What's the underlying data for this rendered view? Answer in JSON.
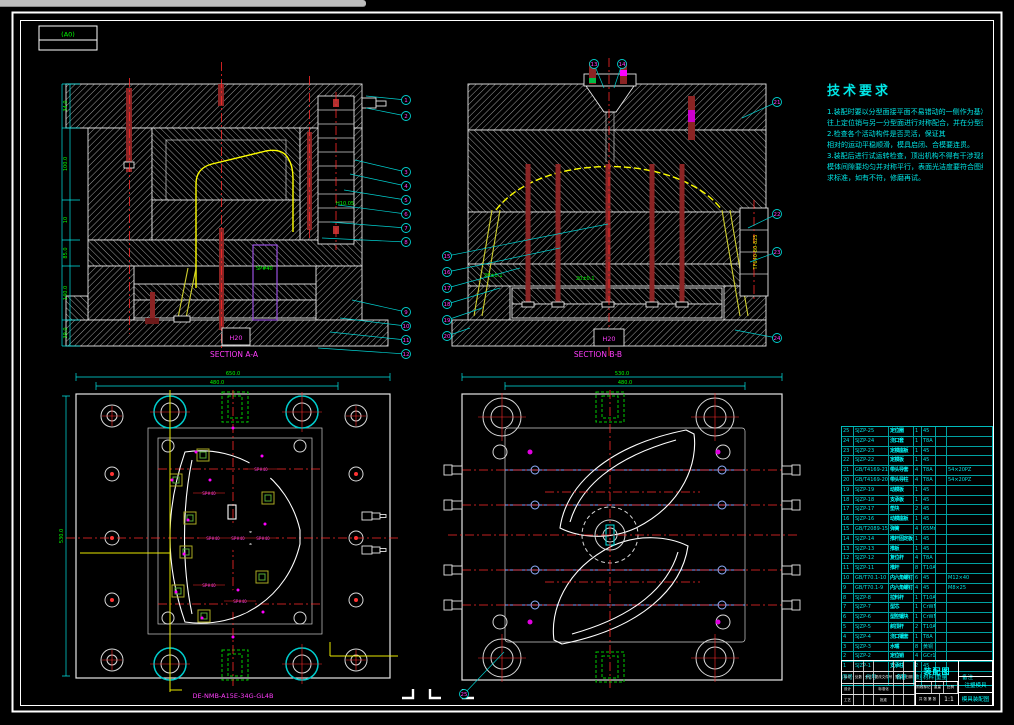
{
  "frame": {
    "format_label": "(A0)"
  },
  "sections": {
    "a": "SECTION A-A",
    "b": "SECTION B-B"
  },
  "tech_requirements": {
    "title": "技术要求",
    "lines": [
      "1.装配时要以分型面接平面不易错动的一侧作为基准，",
      "往上定位销与另一分型面进行对称配合，并在分型面留有间隙。",
      "2.检查各个活动构件是否灵活，保证其",
      "相对的运动平稳顺滑，模具启闭、合模要连贯。",
      "3.装配后进行试运转检查，顶出机构不得有干涉现象，",
      "模体间隙要均匀并对称平行，表面光洁度要符合图纸要",
      "求标准，如有不符，修磨再试。"
    ]
  },
  "view_tl": {
    "dims_left": [
      "34.0",
      "100.0",
      "10",
      "85.0",
      "140.0",
      "39.0"
    ],
    "label_sp": "SP#40",
    "label_h": "H10.05",
    "label_h20": "H20"
  },
  "view_tr": {
    "label_tf": "TF640-80-825",
    "label_h20": "H20",
    "tol_left": "20±0.1",
    "tol_right": "20±0.1"
  },
  "view_bl": {
    "dim_top1": "650.0",
    "dim_top2": "480.0",
    "dim_left": "530.0",
    "sp_label": "SP#40",
    "part_no": "DE-NMB-A15E-34G-GL4B"
  },
  "view_br": {
    "dim_top1": "530.0",
    "dim_top2": "480.0"
  },
  "bom": {
    "headers": [
      "序号",
      "代号",
      "名称",
      "数量",
      "材料",
      "重量",
      "备注"
    ],
    "rows": [
      [
        "25",
        "SJZP-25",
        "定位圈",
        "1",
        "45",
        "",
        ""
      ],
      [
        "24",
        "SJZP-24",
        "浇口套",
        "1",
        "T8A",
        "",
        ""
      ],
      [
        "23",
        "SJZP-23",
        "定模座板",
        "1",
        "45",
        "",
        ""
      ],
      [
        "22",
        "SJZP-22",
        "定模板",
        "1",
        "45",
        "",
        ""
      ],
      [
        "21",
        "GB/T4169-21",
        "带头导套",
        "4",
        "T8A",
        "",
        "54×20PZ"
      ],
      [
        "20",
        "GB/T4169-20",
        "带头导柱",
        "4",
        "T8A",
        "",
        "54×20PZ"
      ],
      [
        "19",
        "SJZP-19",
        "动模板",
        "1",
        "45",
        "",
        ""
      ],
      [
        "18",
        "SJZP-18",
        "支承板",
        "1",
        "45",
        "",
        ""
      ],
      [
        "17",
        "SJZP-17",
        "垫块",
        "2",
        "45",
        "",
        ""
      ],
      [
        "16",
        "SJZP-16",
        "动模座板",
        "1",
        "45",
        "",
        ""
      ],
      [
        "15",
        "GB/T2089-15",
        "弹簧",
        "4",
        "65Mn",
        "",
        ""
      ],
      [
        "14",
        "SJZP-14",
        "推杆固定板",
        "1",
        "45",
        "",
        ""
      ],
      [
        "13",
        "SJZP-13",
        "推板",
        "1",
        "45",
        "",
        ""
      ],
      [
        "12",
        "SJZP-12",
        "复位杆",
        "4",
        "T8A",
        "",
        ""
      ],
      [
        "11",
        "SJZP-11",
        "推杆",
        "8",
        "T10A",
        "",
        ""
      ],
      [
        "10",
        "GB/T70.1-10",
        "内六角螺钉",
        "6",
        "45",
        "",
        "M12×40"
      ],
      [
        "9",
        "GB/T70.1-9",
        "内六角螺钉",
        "4",
        "45",
        "",
        "M8×25"
      ],
      [
        "8",
        "SJZP-8",
        "拉料杆",
        "1",
        "T10A",
        "",
        ""
      ],
      [
        "7",
        "SJZP-7",
        "型芯",
        "1",
        "CrWMn",
        "",
        ""
      ],
      [
        "6",
        "SJZP-6",
        "型腔镶块",
        "1",
        "CrWMn",
        "",
        ""
      ],
      [
        "5",
        "SJZP-5",
        "斜顶杆",
        "2",
        "T10A",
        "",
        ""
      ],
      [
        "4",
        "SJZP-4",
        "浇口镶套",
        "1",
        "T8A",
        "",
        ""
      ],
      [
        "3",
        "SJZP-3",
        "水嘴",
        "8",
        "黄铜",
        "",
        ""
      ],
      [
        "2",
        "SJZP-2",
        "定位销",
        "4",
        "GCr15",
        "",
        ""
      ],
      [
        "1",
        "SJZP-1",
        "支承柱",
        "2",
        "45",
        "",
        ""
      ]
    ]
  },
  "title_block": {
    "name": "装配图",
    "scale_value": "1:1",
    "labels": {
      "mark": "标记",
      "count": "处数",
      "zone": "分区",
      "doc": "更改文件号",
      "sign": "签字",
      "date": "日期",
      "design": "设计",
      "check": "校核",
      "standard": "标准化",
      "craft": "工艺",
      "approve": "批准",
      "stage": "阶段标记",
      "weight": "重量",
      "scale": "比例",
      "sheet": "共 张 第 张"
    },
    "right_mid": "注塑模具",
    "right_bottom": "模具装配图"
  },
  "balloons": [
    {
      "n": "1",
      "x": 406,
      "y": 100,
      "sx": 366,
      "sy": 96
    },
    {
      "n": "2",
      "x": 406,
      "y": 116,
      "sx": 366,
      "sy": 108
    },
    {
      "n": "3",
      "x": 406,
      "y": 172,
      "sx": 355,
      "sy": 160
    },
    {
      "n": "4",
      "x": 406,
      "y": 186,
      "sx": 350,
      "sy": 174
    },
    {
      "n": "5",
      "x": 406,
      "y": 200,
      "sx": 344,
      "sy": 190
    },
    {
      "n": "6",
      "x": 406,
      "y": 214,
      "sx": 338,
      "sy": 205
    },
    {
      "n": "7",
      "x": 406,
      "y": 228,
      "sx": 330,
      "sy": 222
    },
    {
      "n": "8",
      "x": 406,
      "y": 242,
      "sx": 322,
      "sy": 238
    },
    {
      "n": "9",
      "x": 406,
      "y": 312,
      "sx": 352,
      "sy": 300
    },
    {
      "n": "10",
      "x": 406,
      "y": 326,
      "sx": 340,
      "sy": 318
    },
    {
      "n": "11",
      "x": 406,
      "y": 340,
      "sx": 330,
      "sy": 332
    },
    {
      "n": "12",
      "x": 406,
      "y": 354,
      "sx": 318,
      "sy": 348
    },
    {
      "n": "13",
      "x": 594,
      "y": 64,
      "sx": 604,
      "sy": 88
    },
    {
      "n": "14",
      "x": 622,
      "y": 64,
      "sx": 614,
      "sy": 88
    },
    {
      "n": "15",
      "x": 447,
      "y": 256,
      "sx": 608,
      "sy": 224
    },
    {
      "n": "16",
      "x": 447,
      "y": 272,
      "sx": 560,
      "sy": 248
    },
    {
      "n": "17",
      "x": 447,
      "y": 288,
      "sx": 520,
      "sy": 268
    },
    {
      "n": "18",
      "x": 447,
      "y": 304,
      "sx": 500,
      "sy": 288
    },
    {
      "n": "19",
      "x": 447,
      "y": 320,
      "sx": 482,
      "sy": 308
    },
    {
      "n": "20",
      "x": 447,
      "y": 336,
      "sx": 470,
      "sy": 328
    },
    {
      "n": "21",
      "x": 777,
      "y": 102,
      "sx": 742,
      "sy": 118
    },
    {
      "n": "22",
      "x": 777,
      "y": 214,
      "sx": 748,
      "sy": 228
    },
    {
      "n": "23",
      "x": 777,
      "y": 252,
      "sx": 750,
      "sy": 262
    },
    {
      "n": "24",
      "x": 777,
      "y": 338,
      "sx": 735,
      "sy": 330
    },
    {
      "n": "25",
      "x": 464,
      "y": 694,
      "sx": 504,
      "sy": 652
    }
  ],
  "colors": {
    "background": "#000000",
    "frame": "#ffffff",
    "dimension": "#00e5e5",
    "dim_text": "#00ff00",
    "part_outline": "#ffff00",
    "centerline": "#ff2a2a",
    "callout": "#ff3dfc",
    "insert": "#9a4fe0",
    "pin": "#8b2424",
    "cooling": "#7f9fff",
    "table_grid": "#00bcbc"
  }
}
